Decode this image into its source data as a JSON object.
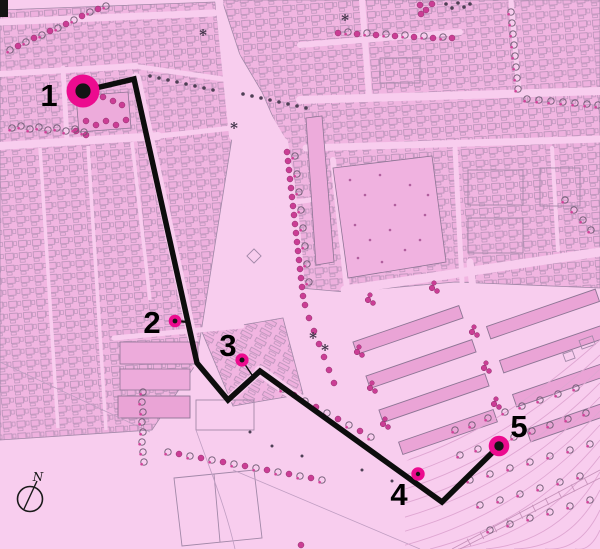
{
  "map": {
    "type": "city-plan-with-route",
    "route_stop_count": 5
  },
  "waypoints": [
    {
      "label": "1"
    },
    {
      "label": "2"
    },
    {
      "label": "3"
    },
    {
      "label": "4"
    },
    {
      "label": "5"
    }
  ],
  "compass": {
    "north_label": "N"
  },
  "decorations": {
    "asterisk": "*"
  },
  "colors": {
    "background": "#f8cdee",
    "block_fill": "#f1b5e1",
    "route": "#0d0d0d",
    "marker_fill": "#ec0b8f",
    "marker_core": "#141414",
    "tree_magenta": "#cb3d95",
    "contour": "#dfa6d2",
    "waypoint_label": "#000000"
  }
}
